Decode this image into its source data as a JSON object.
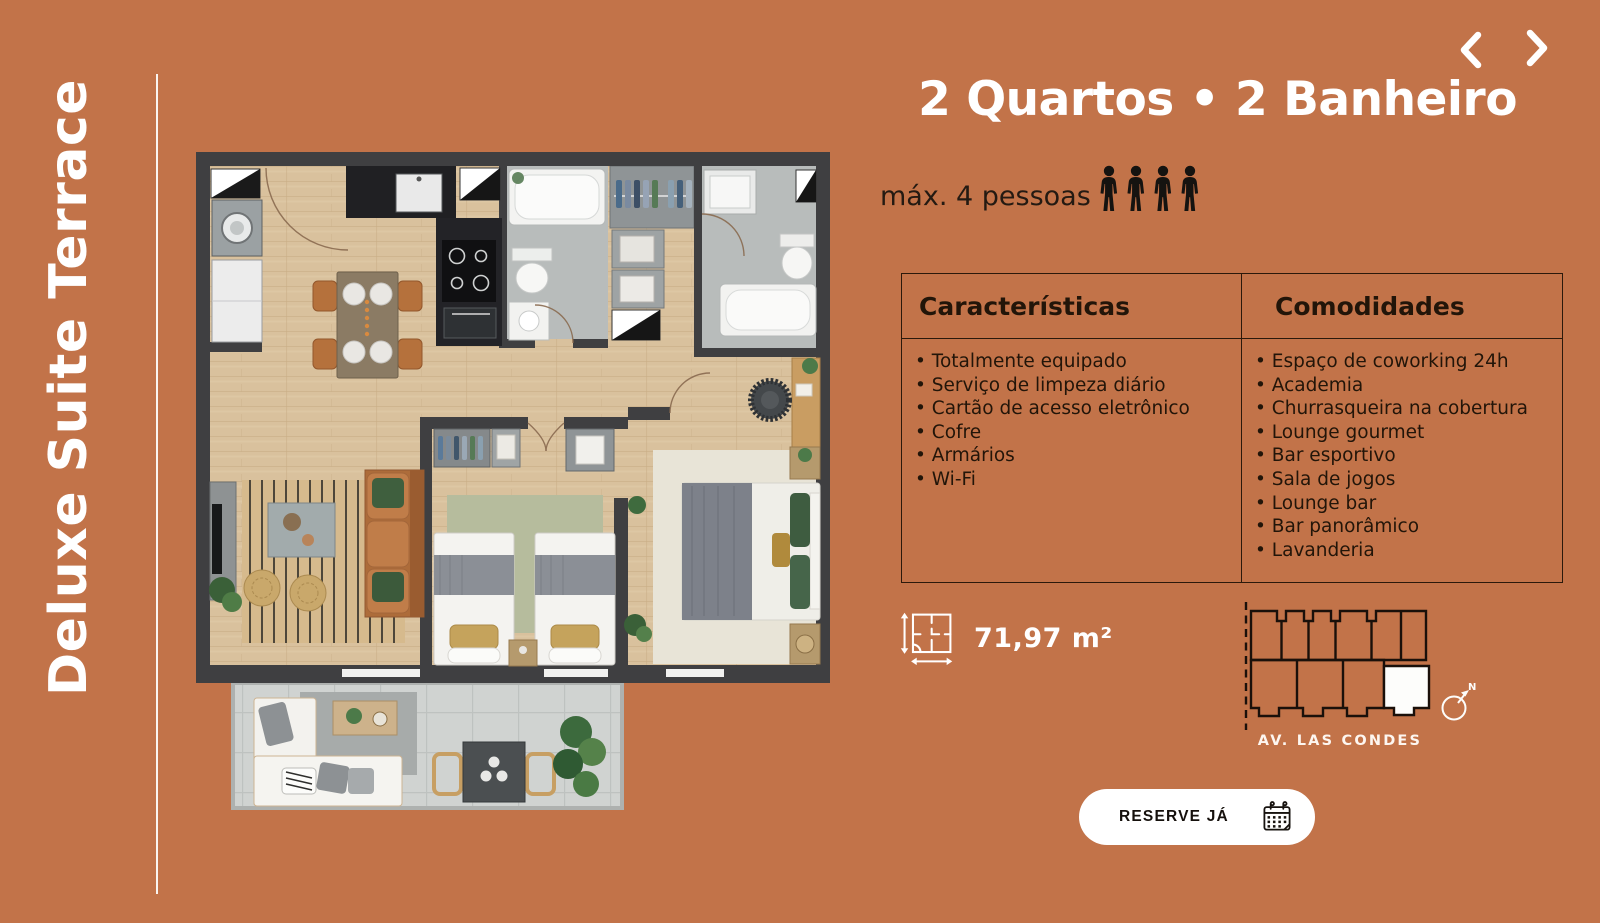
{
  "slide": {
    "vertical_title": "Deluxe Suite Terrace",
    "colors": {
      "background": "#c27349",
      "table_border": "#2b190b",
      "text_dark": "#241a12",
      "white": "#ffffff"
    }
  },
  "header": {
    "title": "2 Quartos • 2 Banheiro",
    "capacity_label": "máx. 4 pessoas",
    "capacity_count": 4
  },
  "table": {
    "columns": [
      {
        "header": "Características",
        "items": [
          "Totalmente equipado",
          "Serviço de limpeza diário",
          "Cartão de acesso eletrônico",
          "Cofre",
          "Armários",
          "Wi-Fi"
        ]
      },
      {
        "header": "Comodidades",
        "items": [
          "Espaço de coworking 24h",
          "Academia",
          "Churrasqueira na cobertura",
          "Lounge gourmet",
          "Bar esportivo",
          "Sala de jogos",
          "Lounge bar",
          "Bar panorâmico",
          "Lavanderia"
        ]
      }
    ]
  },
  "details": {
    "area": "71,97 m²",
    "street": "AV. LAS CONDES",
    "compass": "N"
  },
  "cta": {
    "label": "RESERVE JÁ"
  }
}
